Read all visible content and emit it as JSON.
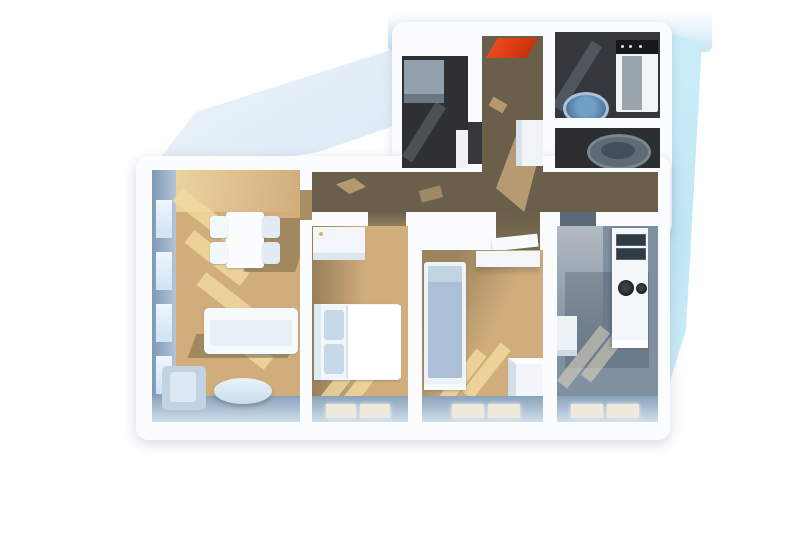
{
  "scene": {
    "type": "3d-floorplan-render",
    "description": "Top-down 3D dollhouse render of an apartment floor plan on a white background, with a pale-blue terrace surface along the top-left and a cyan exterior strip along the right side",
    "rooms": [
      {
        "id": "living-room",
        "floor": "light-wood",
        "features": [
          "left wall with four windows",
          "sunlight stripes on floor"
        ],
        "furniture": [
          "dining-table",
          "four-chairs",
          "sofa",
          "armchair",
          "oval-coffee-table"
        ]
      },
      {
        "id": "bedroom-1",
        "floor": "light-wood",
        "features": [
          "window at bottom wall"
        ],
        "furniture": [
          "double-bed-with-white-duvet-and-blue-pillows",
          "white-wardrobe"
        ]
      },
      {
        "id": "bedroom-2",
        "floor": "light-wood",
        "features": [
          "window at bottom wall"
        ],
        "furniture": [
          "single-bed-blue-mattress",
          "wall-shelf",
          "white-storage-box"
        ]
      },
      {
        "id": "kitchen",
        "floor": "gray-tile",
        "features": [
          "window at bottom wall"
        ],
        "furniture": [
          "counter-with-double-sink",
          "cooktop-two-burners",
          "small-wall-cabinet"
        ]
      },
      {
        "id": "hallway",
        "floor": "dark-wood",
        "features": [
          "entrance at top"
        ],
        "furniture": [
          "red-doormat",
          "hall-cupboard"
        ]
      },
      {
        "id": "bathroom",
        "floor": "dark-tile",
        "furniture": [
          "washing-machine",
          "round-blue-washbasin"
        ]
      },
      {
        "id": "wc",
        "floor": "dark-tile",
        "furniture": [
          "toilet"
        ]
      },
      {
        "id": "shower-room",
        "floor": "dark-tile",
        "furniture": [
          "shower-tray"
        ]
      }
    ],
    "exterior": [
      "terrace-top-left",
      "terrace-right-strip"
    ]
  },
  "colors": {
    "bg": "#ffffff",
    "wall": "#fbfcfe",
    "terrace": "#b7cde5",
    "terraceRight": "#bfe7f5",
    "wood": "#d2ad7c",
    "hallWood": "#6a5f4a",
    "tileDark": "#2e3134",
    "tileKitchen": "#8090a0",
    "wallFace": "#7f98b5",
    "glass": "#cfe3f4",
    "bottomFace": "#8aa2bc",
    "mat": "#c22a06",
    "duvet": "#ffffff",
    "pillow": "#c7d8e8",
    "mattress": "#abbfd6",
    "sofa": "#f7fafd",
    "armchair": "#c2d2e2",
    "table": "#c8dcec",
    "counter": "#f4f7f9",
    "cooktop": "#1b1e21",
    "sink": "#4a6f92",
    "sinkRim": "#a9c2da",
    "toilet": "#5e6a74",
    "machineTop": "#16181a",
    "machineBody": "#f1f4f6",
    "shower": "#93a0ae"
  }
}
